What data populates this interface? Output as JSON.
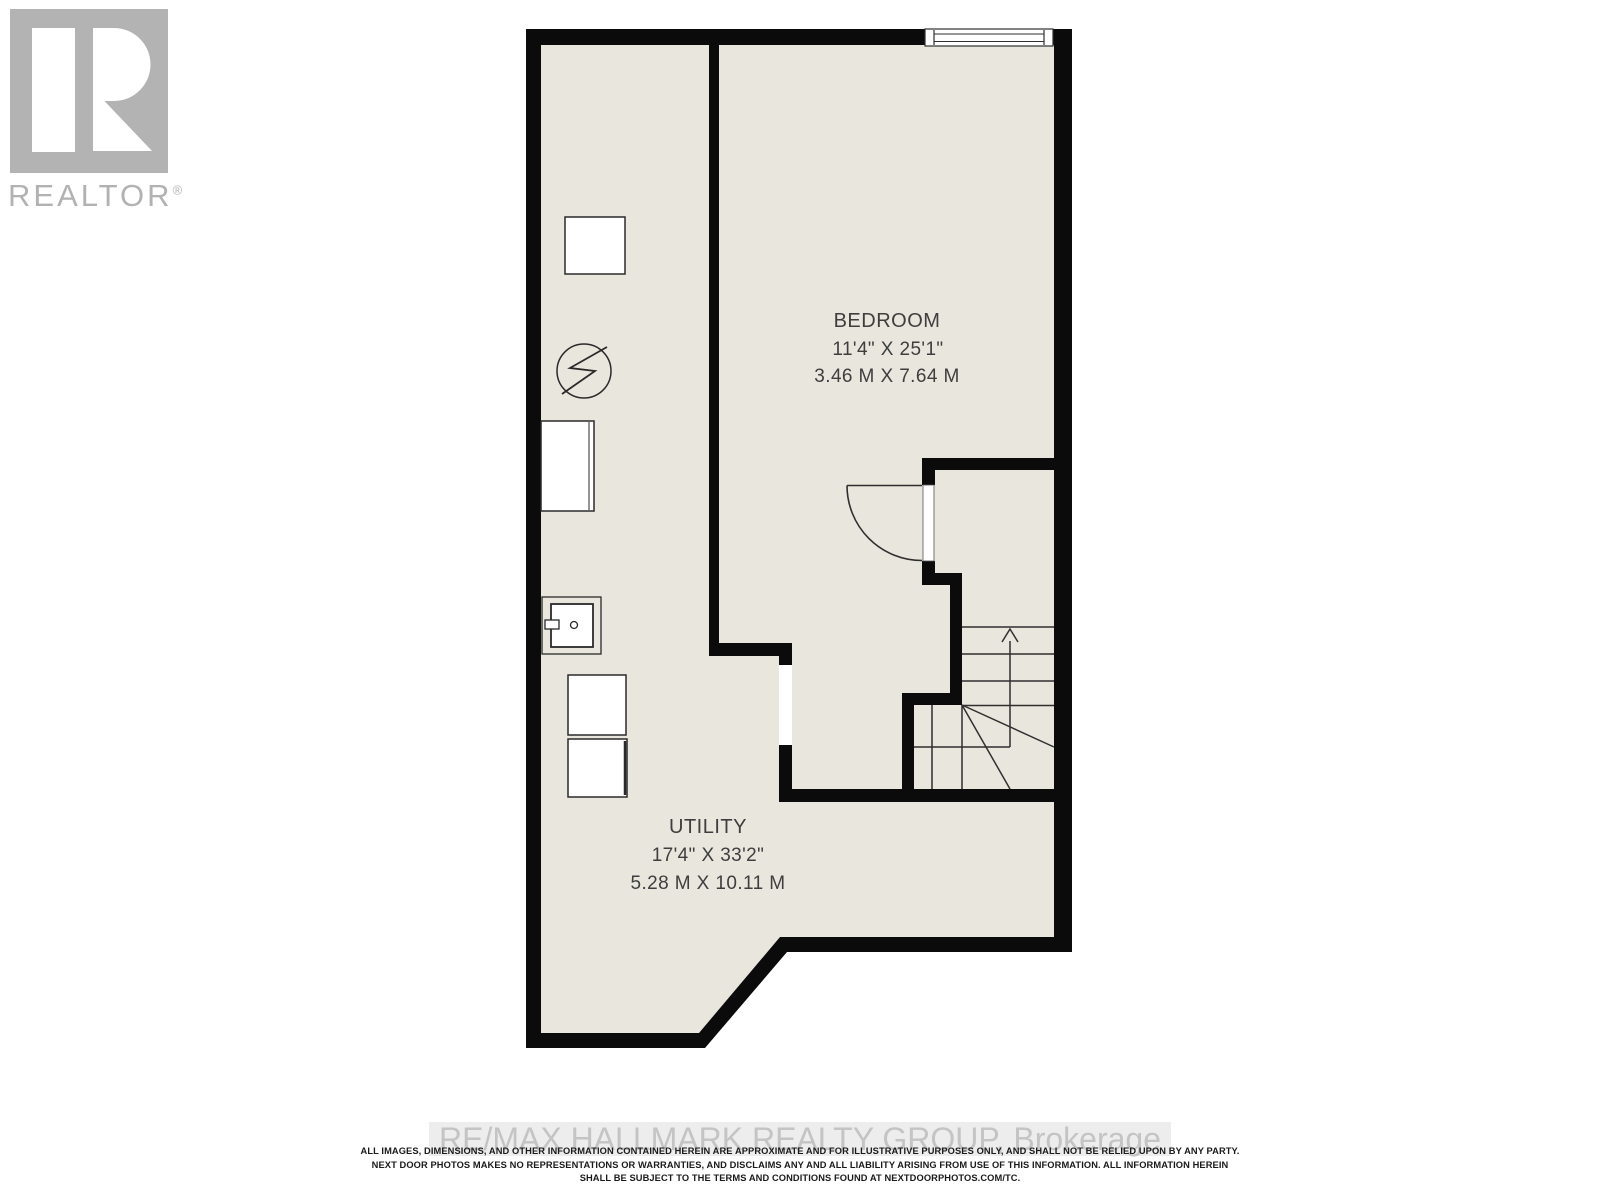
{
  "branding": {
    "logo_text": "REALTOR",
    "registered_mark": "®",
    "logo_color": "#b3b3b3"
  },
  "plan": {
    "floor_color": "#e8e6dd",
    "wall_color": "#0b0b0b",
    "line_color": "#2f2f2f",
    "rooms": [
      {
        "id": "bedroom",
        "name": "BEDROOM",
        "dimensions_imperial": "11'4\" X 25'1\"",
        "dimensions_metric": "3.46 M X 7.64 M"
      },
      {
        "id": "utility",
        "name": "UTILITY",
        "dimensions_imperial": "17'4\" X 33'2\"",
        "dimensions_metric": "5.28 M X 10.11 M"
      }
    ],
    "fixtures": [
      "storage-cabinet",
      "electrical-panel",
      "furnace",
      "laundry-tub",
      "washer",
      "dryer"
    ],
    "features": [
      "window",
      "door",
      "staircase-up"
    ]
  },
  "watermark": {
    "text": "RE/MAX HALLMARK REALTY GROUP, Brokerage"
  },
  "disclaimer": {
    "line1": "ALL IMAGES, DIMENSIONS, AND OTHER INFORMATION CONTAINED HEREIN ARE APPROXIMATE AND FOR ILLUSTRATIVE PURPOSES ONLY, AND SHALL NOT BE RELIED UPON BY ANY PARTY.",
    "line2": "NEXT DOOR PHOTOS MAKES NO REPRESENTATIONS OR WARRANTIES, AND DISCLAIMS ANY AND ALL LIABILITY ARISING FROM USE OF THIS INFORMATION. ALL INFORMATION HEREIN",
    "line3": "SHALL BE SUBJECT TO THE TERMS AND CONDITIONS FOUND AT NEXTDOORPHOTOS.COM/TC."
  }
}
